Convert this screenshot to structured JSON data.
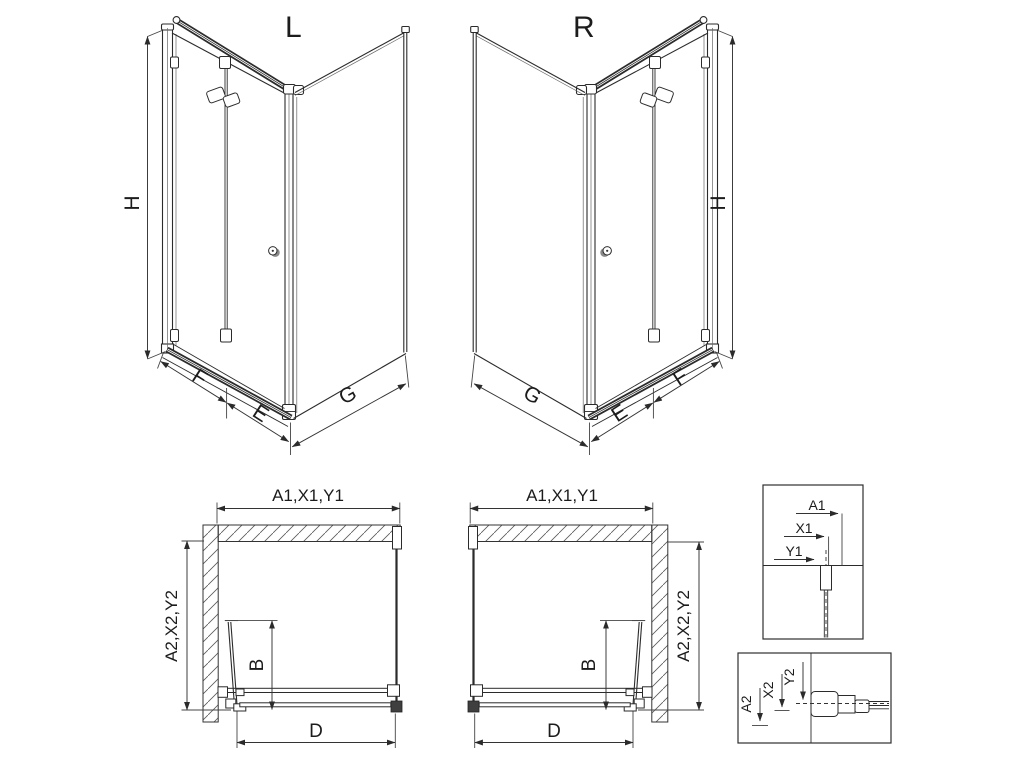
{
  "figure": {
    "background": "#ffffff",
    "line_color": "#2b2b2b"
  },
  "iso_left": {
    "label": "L",
    "dims": {
      "height": "H",
      "front_outer": "F",
      "front_inner": "E",
      "side": "G"
    }
  },
  "iso_right": {
    "label": "R",
    "dims": {
      "height": "H",
      "front_outer": "F",
      "front_inner": "E",
      "side": "G"
    }
  },
  "plan_left": {
    "dims": {
      "top": "A1,X1,Y1",
      "side": "A2,X2,Y2",
      "door": "B",
      "entry": "D"
    }
  },
  "plan_right": {
    "dims": {
      "top": "A1,X1,Y1",
      "side": "A2,X2,Y2",
      "door": "B",
      "entry": "D"
    }
  },
  "detail_top": {
    "dims": [
      "A1",
      "X1",
      "Y1"
    ]
  },
  "detail_bottom": {
    "dims": [
      "A2",
      "X2",
      "Y2"
    ]
  }
}
